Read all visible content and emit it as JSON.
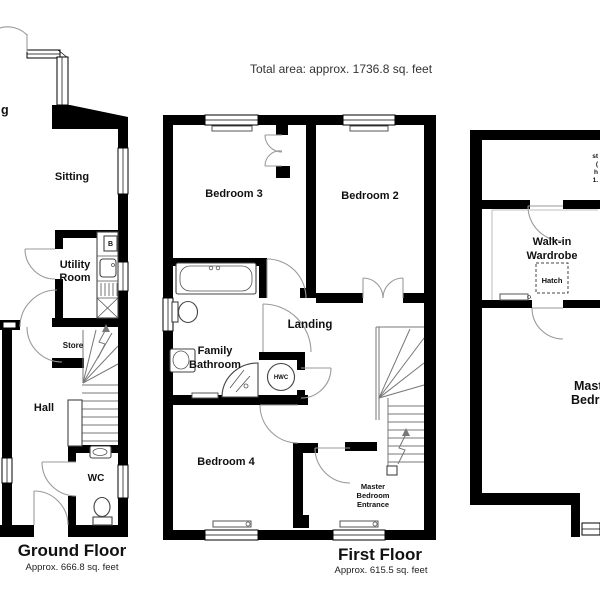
{
  "header": {
    "total_area": "Total area: approx. 1736.8 sq. feet"
  },
  "ground_floor": {
    "title": "Ground Floor",
    "area": "Approx. 666.8 sq. feet",
    "labels": {
      "cutoff_room_fragment": "g",
      "sitting": "Sitting",
      "utility_line1": "Utility",
      "utility_line2": "Room",
      "boiler": "B",
      "store": "Store",
      "hall": "Hall",
      "wc": "WC"
    }
  },
  "first_floor": {
    "title": "First Floor",
    "area": "Approx. 615.5 sq. feet",
    "labels": {
      "bedroom3": "Bedroom 3",
      "bedroom2": "Bedroom 2",
      "family_bathroom_line1": "Family",
      "family_bathroom_line2": "Bathroom",
      "landing": "Landing",
      "hwc": "HWC",
      "bedroom4": "Bedroom 4",
      "master_entrance_line1": "Master",
      "master_entrance_line2": "Bedroom",
      "master_entrance_line3": "Entrance"
    }
  },
  "second_floor": {
    "labels": {
      "walk_in_line1": "Walk-in",
      "walk_in_line2": "Wardrobe",
      "hatch": "Hatch",
      "master_line1": "Master",
      "master_line2": "Bedroom",
      "attic_note_line1": "st",
      "attic_note_line2": "(",
      "attic_note_line3": "h",
      "attic_note_line4": "1."
    }
  }
}
